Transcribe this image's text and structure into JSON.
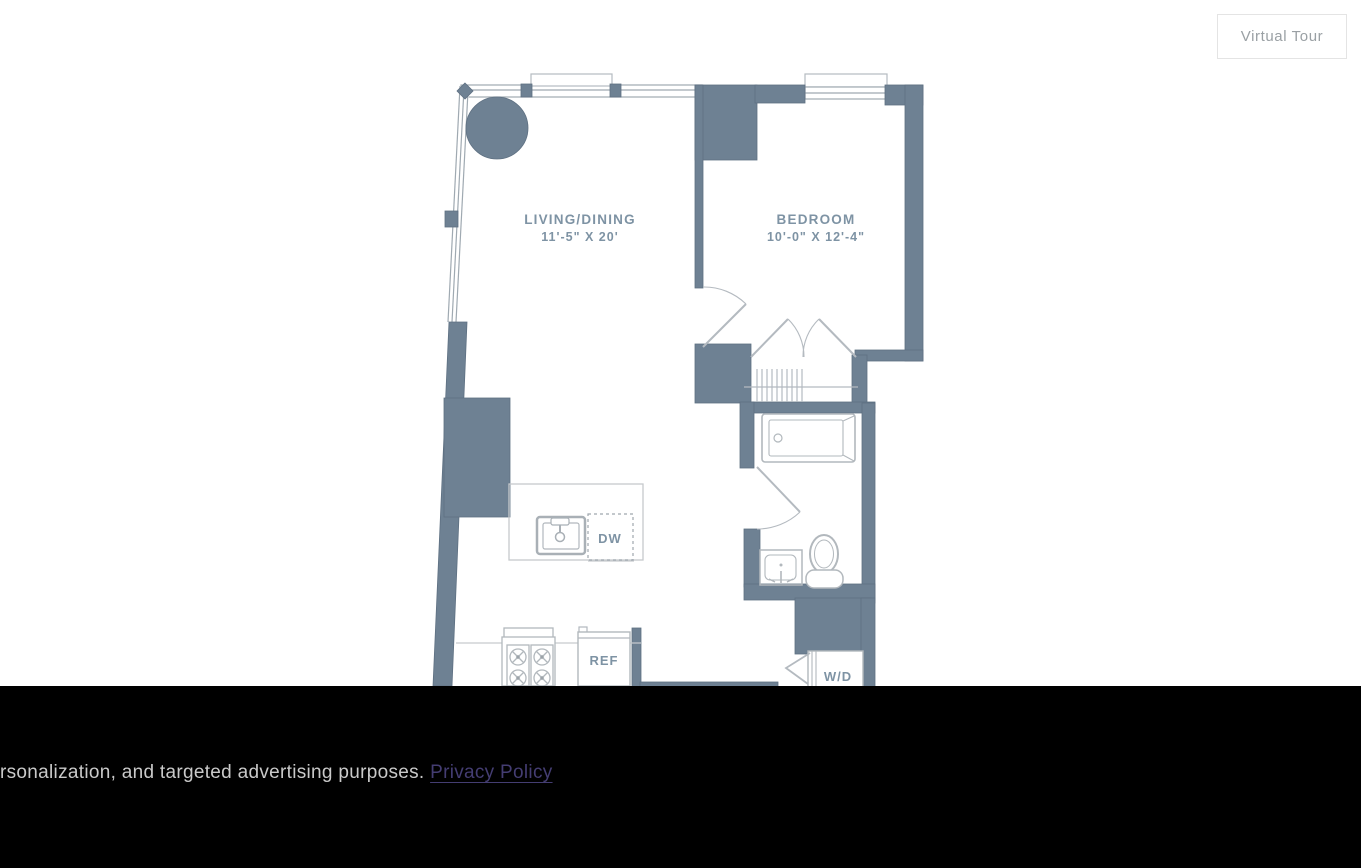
{
  "toolbar": {
    "virtual_tour_label": "Virtual Tour"
  },
  "floor_plan": {
    "rooms": [
      {
        "name": "LIVING/DINING",
        "dimensions": "11'-5\" X 20'"
      },
      {
        "name": "BEDROOM",
        "dimensions": "10'-0\" X 12'-4\""
      }
    ],
    "labels": {
      "dishwasher": "DW",
      "refrigerator": "REF",
      "washer_dryer": "W/D"
    },
    "colors": {
      "wall": "#6E8193",
      "fixture_line": "#b2b8bd",
      "counter_line": "#c6cacd",
      "room_label": "#7E93A4"
    }
  },
  "cookie_banner": {
    "message_fragment": "rsonalization, and targeted advertising purposes. ",
    "privacy_policy_label": "Privacy Policy",
    "colors": {
      "background": "#000000",
      "text": "#c9c9c9",
      "link": "#443d72"
    }
  }
}
